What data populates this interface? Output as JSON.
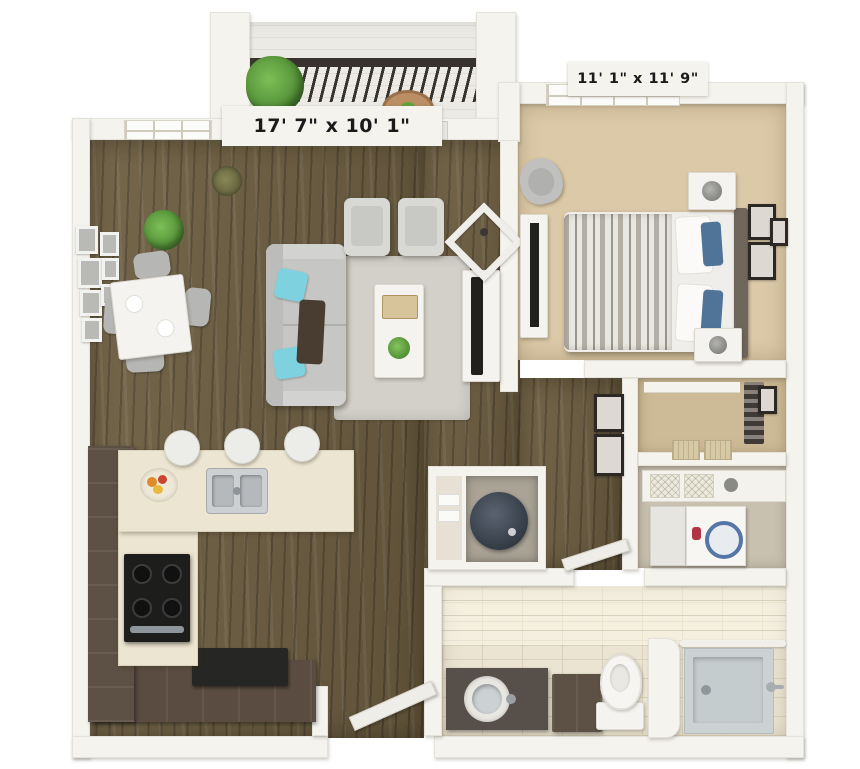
{
  "labels": {
    "living_room_dimensions": "17' 7\" x 10' 1\"",
    "bedroom_dimensions": "11' 1\" x 11' 9\""
  },
  "colors": {
    "bg": "#ffffff",
    "wall": "#f5f3ed",
    "wall_edge": "#d9d5c9",
    "wood": "#6e5f42",
    "carpet": "#dbc9a8",
    "closet_floor": "#cdbb97",
    "tile": "#ebe4d2",
    "grout": "#d9d1bb",
    "rug": "#d2d0c8",
    "sofa": "#c6c6c4",
    "chair": "#d8d8d5",
    "accent_teal": "#7ed2e0",
    "throw_brown": "#493d31",
    "white_furniture": "#f4f3f0",
    "tv_black": "#20201e",
    "counter": "#ece5d1",
    "cabinet_dark": "#5d5044",
    "island_dark": "#5a4c41",
    "stove_black": "#1d1d1b",
    "steel": "#b9bec2",
    "bed_blue": "#4f7498",
    "duvet_gray": "#b3afa6",
    "headboard": "#6f665c",
    "water_heater": "#39414c",
    "tub_gray": "#ccd2d4",
    "railing_dark": "#37322c",
    "plant_green": "#61a23e",
    "table_wood": "#bb8e63",
    "frame_dark": "#2c2824",
    "label_bg": "#f5f3ed",
    "label_text": "#1b1b1b"
  },
  "rooms": {
    "balcony": {
      "furniture": [
        "planter-bush",
        "bistro-table"
      ]
    },
    "living_dining": {
      "furniture": [
        "sofa",
        "two-armchairs",
        "coffee-table",
        "area-rug",
        "tv-console",
        "diamond-decor",
        "dining-table",
        "dining-chairs",
        "gallery-wall",
        "potted-plant",
        "wreath",
        "credenza"
      ]
    },
    "kitchen": {
      "furniture": [
        "breakfast-bar",
        "three-bar-stools",
        "double-sink",
        "fruit-bowl",
        "range-stove",
        "dark-cabinets",
        "island-cabinets"
      ]
    },
    "bedroom": {
      "furniture": [
        "bed",
        "patterned-duvet",
        "two-nightstands",
        "lamps",
        "dresser-with-tv",
        "accent-chair",
        "wall-art",
        "window"
      ]
    },
    "walk_in_closet": {
      "furniture": [
        "hanging-clothes",
        "shelf",
        "baskets"
      ]
    },
    "laundry_closet": {
      "furniture": [
        "washer-dryer",
        "shelf-baskets"
      ]
    },
    "bathroom": {
      "furniture": [
        "vanity-with-round-sink",
        "dark-cabinet",
        "toilet",
        "partition",
        "shower-pan",
        "shower-rod",
        "shower-fixture"
      ]
    },
    "utility_closet": {
      "furniture": [
        "water-heater",
        "shelves"
      ]
    },
    "entry": {
      "furniture": [
        "open-door"
      ]
    }
  }
}
